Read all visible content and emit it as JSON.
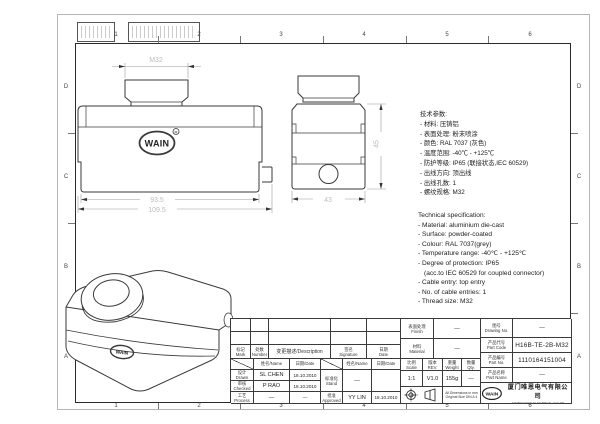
{
  "frame": {
    "grid_cols": [
      "1",
      "2",
      "3",
      "4",
      "5",
      "6"
    ],
    "grid_rows": [
      "D",
      "C",
      "B",
      "A"
    ]
  },
  "views": {
    "logo_text": "WAIN",
    "logo_reg": "R",
    "front": {
      "dim_thread": "M32",
      "dim_width_inner": "93.5",
      "dim_width_outer": "109.5"
    },
    "side": {
      "dim_width": "43",
      "dim_height": "45"
    },
    "iso": {
      "logo_text": "WAIN"
    }
  },
  "specs_cn": {
    "lines": [
      "技术参数:",
      "- 材料: 压铸铝",
      "- 表面处理: 粉末喷涂",
      "- 颜色: RAL 7037 (灰色)",
      "- 温度范围: -40℃ - +125℃",
      "- 防护等级: IP65 (联接状态,IEC 60529)",
      "- 出线方向: 顶出线",
      "- 出线孔数: 1",
      "- 螺纹规格: M32"
    ]
  },
  "specs_en": {
    "lines": [
      "Technical specification:",
      "- Material: aluminium die-cast",
      "- Surface: powder-coated",
      "- Colour: RAL 7037(grey)",
      "- Temperature range: -40℃ - +125℃",
      "- Degree of protection: IP65",
      "(acc.to IEC 60529 for coupled connector)",
      "- Cable entry: top entry",
      "- No. of cable entries: 1",
      "- Thread size: M32"
    ]
  },
  "title_block": {
    "rev_table": {
      "mark_cn": "标记",
      "mark_en": "Mark",
      "number_cn": "处数",
      "number_en": "Number",
      "description": "变更描述/Description",
      "signature_cn": "签名",
      "signature_en": "Signature",
      "date_cn": "日期",
      "date_en": "Date",
      "name_header": "姓名/Name",
      "date_header": "日期/Date"
    },
    "drawn": {
      "cn": "设计",
      "en": "Drawn",
      "name": "SL CHEN",
      "date": "18.10.2010"
    },
    "checked": {
      "cn": "审核",
      "en": "Checked",
      "name": "P RAO",
      "date": "18.10.2010"
    },
    "process": {
      "cn": "工艺",
      "en": "Process",
      "name": "—",
      "date": "—"
    },
    "stand": {
      "cn": "标准化",
      "en": "Stand",
      "name": "—",
      "date": ""
    },
    "approved": {
      "cn": "批准",
      "en": "Approved",
      "name": "YY LIN",
      "date": "18.10.2010"
    },
    "finish": {
      "cn": "表面处理",
      "en": "Finish",
      "value": "—"
    },
    "material": {
      "cn": "材料",
      "en": "Material",
      "value": "—"
    },
    "scale": {
      "cn": "比例",
      "en": "Scale",
      "value": "1:1"
    },
    "rev": {
      "cn": "版本",
      "en": "REV.",
      "value": "V1.0"
    },
    "weight": {
      "cn": "重量",
      "en": "Weight",
      "value": "155g"
    },
    "qty": {
      "cn": "数量",
      "en": "Qty.",
      "value": "—"
    },
    "notes": {
      "line1": "All Dimensions in mm",
      "line2": "Original Size DIN A 4"
    },
    "drawing_no": {
      "cn": "图号",
      "en": "Drawing No.",
      "value": "—"
    },
    "part_code": {
      "cn": "产品代号",
      "en": "Part Code",
      "value": "H16B-TE-2B-M32"
    },
    "part_no": {
      "cn": "产品编号",
      "en": "Part No.",
      "value": "1110164151004"
    },
    "part_name": {
      "cn": "产品名称",
      "en": "Part Name",
      "value": "—"
    },
    "company": {
      "logo": "WAIN",
      "name_cn": "厦门唯恩电气有限公司",
      "name_en": "XIAMEN WAIN ELECTRICAL CO.LTD"
    }
  }
}
